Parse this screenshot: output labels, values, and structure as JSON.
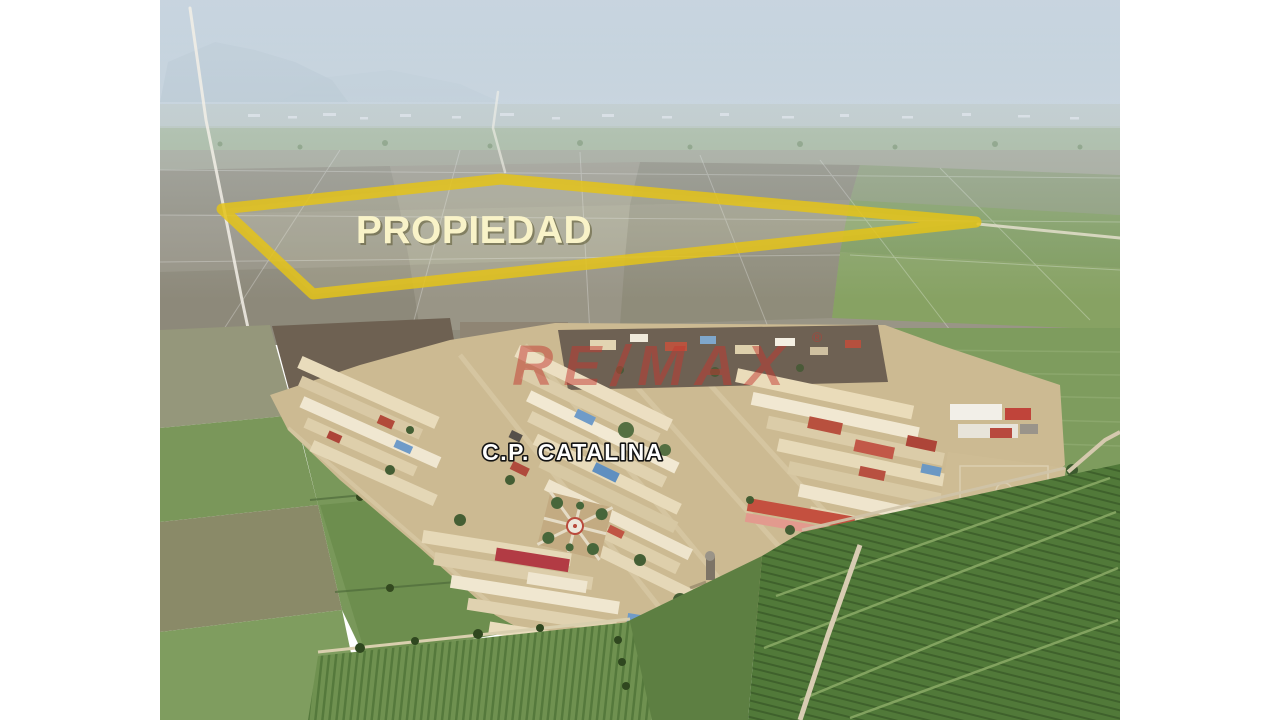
{
  "page": {
    "background": "#ffffff"
  },
  "annotations": {
    "property_label": {
      "text": "PROPIEDAD",
      "color": "#f9f3c8"
    },
    "village_label": {
      "text": "C.P. CATALINA",
      "color": "#ffffff"
    },
    "watermark": {
      "text": "RE/MAX",
      "registered_mark": "®",
      "color": "#c1372f"
    }
  },
  "colors": {
    "property_outline": "#e4c319",
    "sky_top": "#b7cad7",
    "sky_horizon": "#ccd8df",
    "farmland_gray": "#999586",
    "field_green": "#7a975a",
    "orchard_green": "#517939",
    "village_tan": "#e6d9b8",
    "roof_red": "#b8503e"
  }
}
